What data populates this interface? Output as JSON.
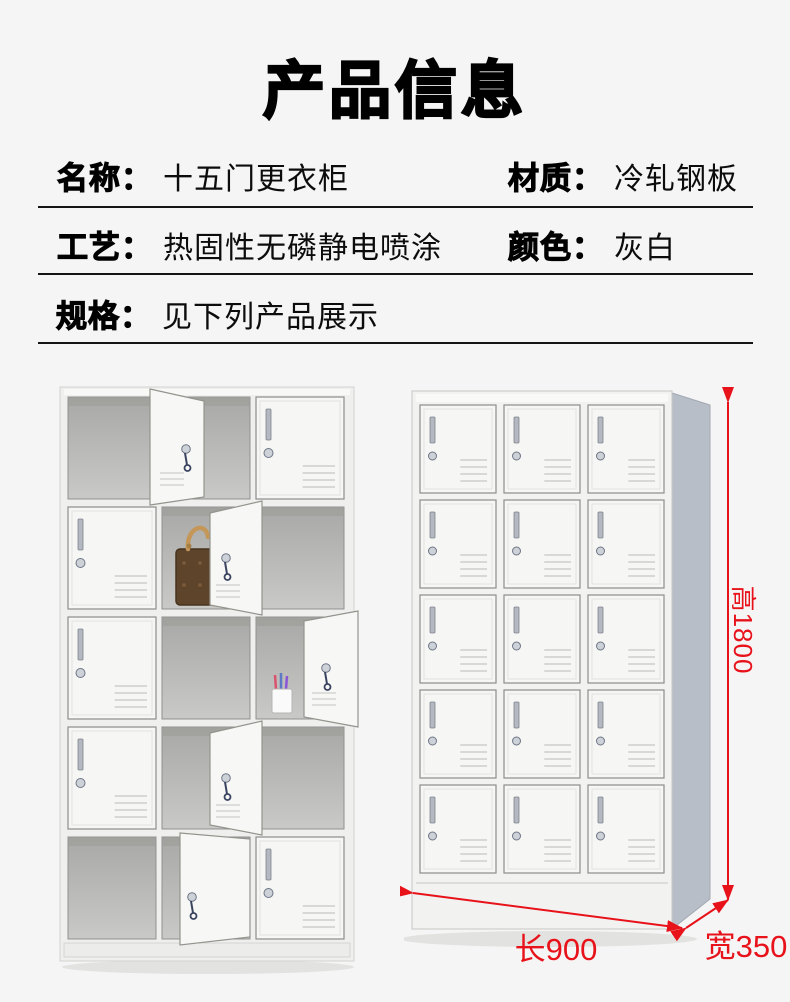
{
  "theme": {
    "background": "#f5f5f6",
    "divider": "#141414",
    "dimension_red": "#e8121a",
    "locker_body": "#efefed",
    "locker_side_panel": "#b8bec8"
  },
  "header": {
    "title": "产品信息"
  },
  "specs": {
    "name": {
      "label": "名称：",
      "value": "十五门更衣柜"
    },
    "material": {
      "label": "材质：",
      "value": "冷轧钢板"
    },
    "process": {
      "label": "工艺：",
      "value": "热固性无磷静电喷涂"
    },
    "color": {
      "label": "颜色：",
      "value": "灰白"
    },
    "size": {
      "label": "规格：",
      "value": "见下列产品展示"
    }
  },
  "product_display": {
    "left_image_alt": "fifteen-door locker, several doors open, handbag and cup inside",
    "right_image_alt": "fifteen-door locker, all doors closed, with dimension arrows",
    "left_locker": {
      "grid": "3x5",
      "cells": [
        [
          "open",
          "door-wide",
          "closed"
        ],
        [
          "closed",
          "open-bag",
          "door-left"
        ],
        [
          "closed",
          "open",
          "open-cup"
        ],
        [
          "closed",
          "open",
          "door-left"
        ],
        [
          "open",
          "door-ajar",
          "closed"
        ]
      ]
    },
    "right_locker": {
      "grid": "3x5",
      "state": "all-closed"
    },
    "dimensions": {
      "height": "高1800",
      "length": "长900",
      "width": "宽350"
    }
  }
}
